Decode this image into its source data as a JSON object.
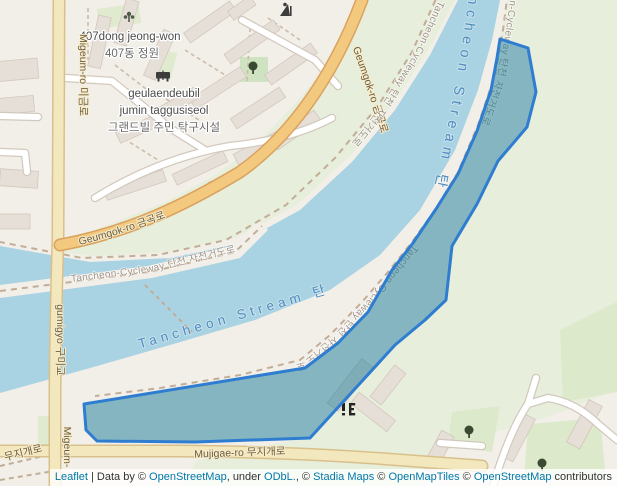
{
  "map": {
    "place_labels": {
      "dong_garden_en": "407dong jeong-won",
      "dong_garden_ko": "407동 정원",
      "grandville_line1": "geulaendeubil",
      "grandville_line2": "jumin taggusiseol",
      "grandville_ko": "그랜드빌 주민 탁구시설"
    },
    "road_labels": {
      "migeum_ro": "Migeum-ro 미금로",
      "gumigyo": "gumigyo 구미교",
      "migeum_partial": "Migeum-",
      "geumgok_ro_west": "Geumgok-ro 금곡로",
      "geumgok_ro_north": "Geumgok-ro 금곡로",
      "mujigae_ro": "Mujigae-ro 무지개로",
      "mujigae_ro_corner": "무지개로"
    },
    "stream_labels": {
      "main": "Tancheon Stream 탄 천",
      "lower": "Tancheon Stream 탄 천"
    },
    "cycleway_label": "Tancheon-Cycleway 탄천 자전거도로",
    "colors": {
      "land": "#f2efe9",
      "green": "#e7eedb",
      "green_dark": "#dde9cb",
      "water": "#a9d2e2",
      "road_yellow_fill": "#f3e7bd",
      "road_yellow_casing": "#d9c08a",
      "road_orange_fill": "#f2c97e",
      "road_orange_casing": "#dba25e",
      "building": "#e6dfd8",
      "building_outline": "#d2c7bc",
      "selection_stroke": "#2e7dd1",
      "selection_fill": "rgba(10,116,146,0.47)",
      "stream_label": "#4e8dc0",
      "path_label": "#a2958a",
      "road_label": "#6d5c42",
      "place_label": "#4c4c4c",
      "link": "#0078a8"
    }
  },
  "attribution": {
    "parts": [
      {
        "text": "Leaflet",
        "link": true
      },
      {
        "text": " | Data by © ",
        "link": false
      },
      {
        "text": "OpenStreetMap",
        "link": true
      },
      {
        "text": ", under ",
        "link": false
      },
      {
        "text": "ODbL.",
        "link": true
      },
      {
        "text": ", © ",
        "link": false
      },
      {
        "text": "Stadia Maps",
        "link": true
      },
      {
        "text": " © ",
        "link": false
      },
      {
        "text": "OpenMapTiles",
        "link": true
      },
      {
        "text": " © ",
        "link": false
      },
      {
        "text": "OpenStreetMap",
        "link": true
      },
      {
        "text": " contributors",
        "link": false
      }
    ]
  }
}
